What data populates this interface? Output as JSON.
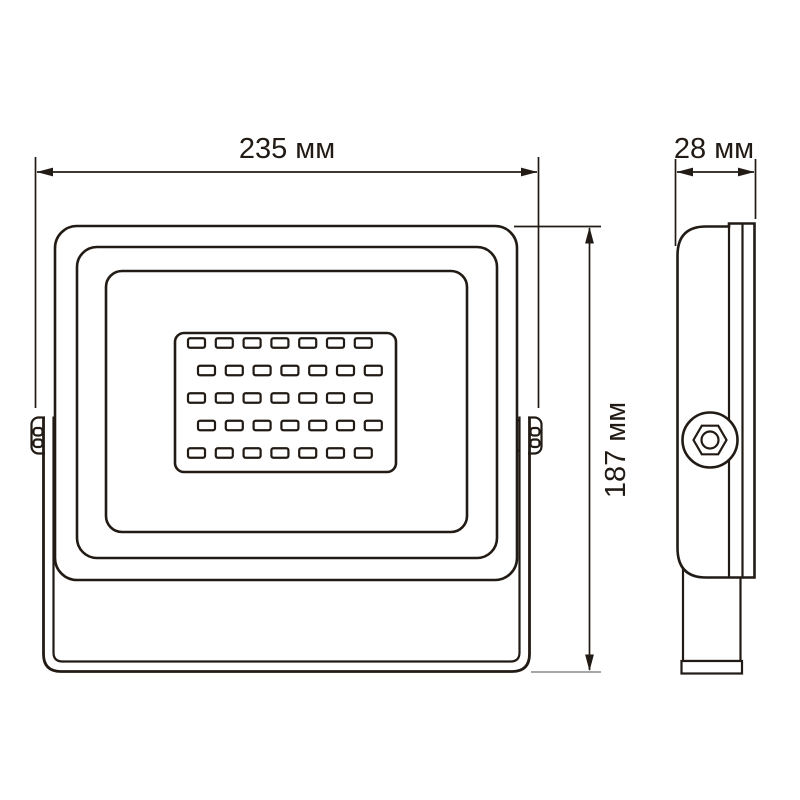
{
  "drawing": {
    "type": "technical-dimension-drawing",
    "subject": "led-floodlight",
    "background_color": "#ffffff",
    "colors": {
      "line": "#221b15",
      "dim_extension_gray": "#9a9a9a"
    },
    "dimensions": {
      "width_label": "235 мм",
      "depth_label": "28 мм",
      "height_label": "187 мм"
    },
    "front_view": {
      "led_grid": {
        "rows": 5,
        "per_row": 7,
        "total": 35
      }
    },
    "side_view": {
      "bolt": "hex-bolt"
    }
  }
}
